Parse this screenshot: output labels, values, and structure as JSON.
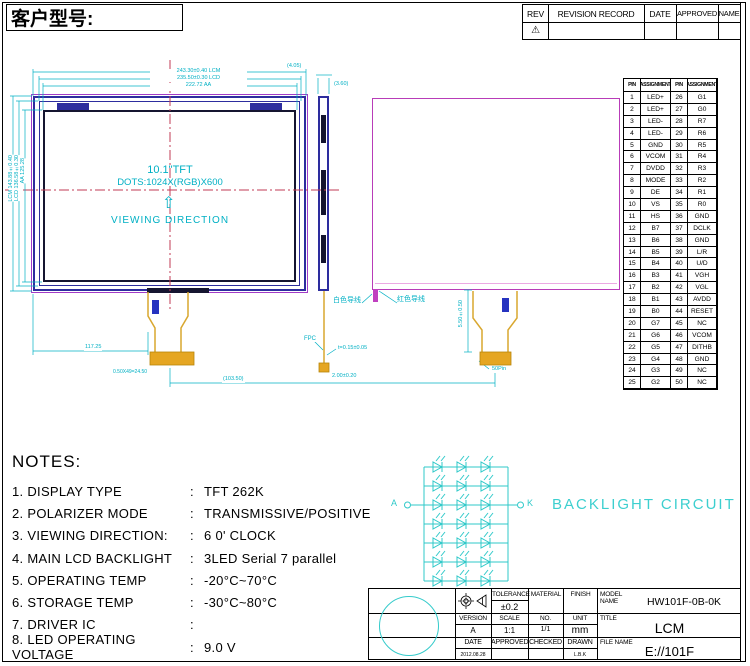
{
  "page": {
    "customer_label": "客户型号:"
  },
  "colors": {
    "cyan": "#00B0C4",
    "magenta": "#B83CB8",
    "navy": "#2D2D9E",
    "gold": "#E5A622",
    "centerline_red": "#C23B55"
  },
  "revision_table": {
    "headers": [
      "REV",
      "REVISION RECORD",
      "DATE",
      "APPROVED",
      "NAME"
    ],
    "rev_symbol": "⚠"
  },
  "front_view": {
    "size_label": "10.1\"TFT",
    "dots_label": "DOTS:1024X(RGB)X600",
    "arrow": "⇧",
    "viewing_label": "VIEWING DIRECTION",
    "dim_top_outer": "243.30±0.40 LCM",
    "dim_top_mid": "235.50±0.30 LCD",
    "dim_top_inner": "222.72 AA",
    "dim_corner": "(4.05)",
    "dim_left_outer": "LCM 143.88±0.40",
    "dim_left_mid": "LCD 136.58±0.30",
    "dim_left_inner": "AA 125.28",
    "dim_fpc_offset": "117.25",
    "dim_pitch": "0.50X49=24.50",
    "dim_span": "(103.50)"
  },
  "side_view": {
    "dim_top": "(3.60)",
    "fpc_label": "FPC",
    "thickness": "t=0.15±0.05",
    "dim_bottom": "2.00±0.20"
  },
  "back_view": {
    "wire_white": "白色导线",
    "wire_red": "红色导线",
    "dim_fpc": "5.50±0.50",
    "connector_label": "50Pin"
  },
  "backlight": {
    "title": "BACKLIGHT CIRCUIT",
    "anode": "A",
    "cathode": "K",
    "rows": 7,
    "leds_per_row": 3
  },
  "notes": {
    "title": "NOTES:",
    "colon": ":",
    "items": [
      {
        "label": "1. DISPLAY TYPE",
        "value": "TFT 262K"
      },
      {
        "label": "2. POLARIZER MODE",
        "value": "TRANSMISSIVE/POSITIVE"
      },
      {
        "label": "3. VIEWING DIRECTION:",
        "value": "6 0' CLOCK"
      },
      {
        "label": "4. MAIN LCD BACKLIGHT",
        "value": "3LED Serial 7  parallel"
      },
      {
        "label": "5. OPERATING TEMP",
        "value": "-20°C~70°C"
      },
      {
        "label": "6. STORAGE TEMP",
        "value": "-30°C~80°C"
      },
      {
        "label": "7. DRIVER IC",
        "value": ""
      },
      {
        "label": "8. LED OPERATING VOLTAGE",
        "value": "9.0 V"
      }
    ]
  },
  "pin_table": {
    "headers": [
      "PIN",
      "ASSIGNMENT",
      "PIN",
      "ASSIGNMENT"
    ],
    "rows": [
      [
        "1",
        "LED+",
        "26",
        "G1"
      ],
      [
        "2",
        "LED+",
        "27",
        "G0"
      ],
      [
        "3",
        "LED-",
        "28",
        "R7"
      ],
      [
        "4",
        "LED-",
        "29",
        "R6"
      ],
      [
        "5",
        "GND",
        "30",
        "R5"
      ],
      [
        "6",
        "VCOM",
        "31",
        "R4"
      ],
      [
        "7",
        "DVDD",
        "32",
        "R3"
      ],
      [
        "8",
        "MODE",
        "33",
        "R2"
      ],
      [
        "9",
        "DE",
        "34",
        "R1"
      ],
      [
        "10",
        "VS",
        "35",
        "R0"
      ],
      [
        "11",
        "HS",
        "36",
        "GND"
      ],
      [
        "12",
        "B7",
        "37",
        "DCLK"
      ],
      [
        "13",
        "B6",
        "38",
        "GND"
      ],
      [
        "14",
        "B5",
        "39",
        "L/R"
      ],
      [
        "15",
        "B4",
        "40",
        "U/D"
      ],
      [
        "16",
        "B3",
        "41",
        "VGH"
      ],
      [
        "17",
        "B2",
        "42",
        "VGL"
      ],
      [
        "18",
        "B1",
        "43",
        "AVDD"
      ],
      [
        "19",
        "B0",
        "44",
        "RESET"
      ],
      [
        "20",
        "G7",
        "45",
        "NC"
      ],
      [
        "21",
        "G6",
        "46",
        "VCOM"
      ],
      [
        "22",
        "G5",
        "47",
        "DITHB"
      ],
      [
        "23",
        "G4",
        "48",
        "GND"
      ],
      [
        "24",
        "G3",
        "49",
        "NC"
      ],
      [
        "25",
        "G2",
        "50",
        "NC"
      ]
    ]
  },
  "title_block": {
    "tolerance_label": "TOLERANCE",
    "tolerance": "±0.2",
    "material_label": "MATERIAL",
    "finish_label": "FINISH",
    "model_label": "MODEL NAME",
    "model": "HW101F-0B-0K",
    "version_label": "VERSION",
    "version": "A",
    "scale_label": "SCALE",
    "scale": "1:1",
    "no_label": "NO.",
    "no": "1/1",
    "unit_label": "UNIT",
    "unit": "mm",
    "title_label": "TITLE",
    "title": "LCM",
    "date_label": "DATE",
    "date": "2012.08.28",
    "approved_label": "APPROVED",
    "checked_label": "CHECKED",
    "drawn_label": "DRAWN",
    "drawn": "L.B.K",
    "filename_label": "FILE NAME",
    "filename": "E://101F"
  }
}
